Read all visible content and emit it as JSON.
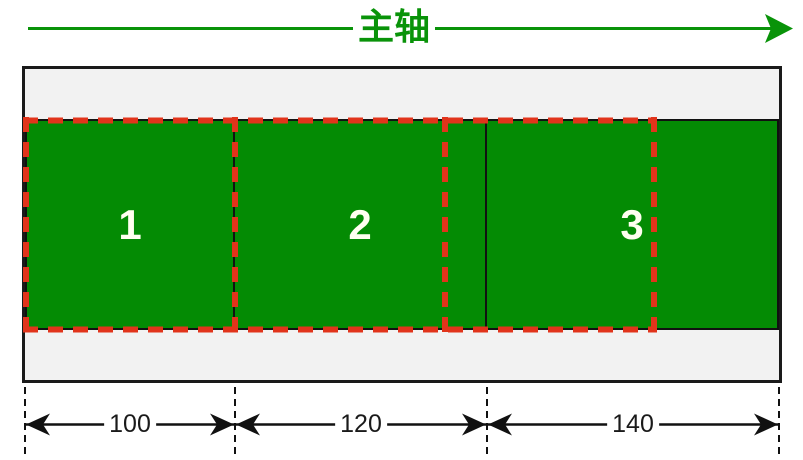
{
  "axis": {
    "label": "主轴",
    "color": "#099309",
    "direction": "left-to-right"
  },
  "container": {
    "background": "#f2f2f2",
    "border_color": "#1a1a1a"
  },
  "items": [
    {
      "label": "1",
      "final_width": 100
    },
    {
      "label": "2",
      "final_width": 120
    },
    {
      "label": "3",
      "final_width": 140
    }
  ],
  "item_color": "#048B04",
  "item_label_color": "#FFFFF0",
  "original_outline": {
    "color": "#E1341B",
    "style": "dashed",
    "width_each": 100,
    "count": 3
  },
  "dimensions": [
    {
      "value": "100"
    },
    {
      "value": "120"
    },
    {
      "value": "140"
    }
  ]
}
